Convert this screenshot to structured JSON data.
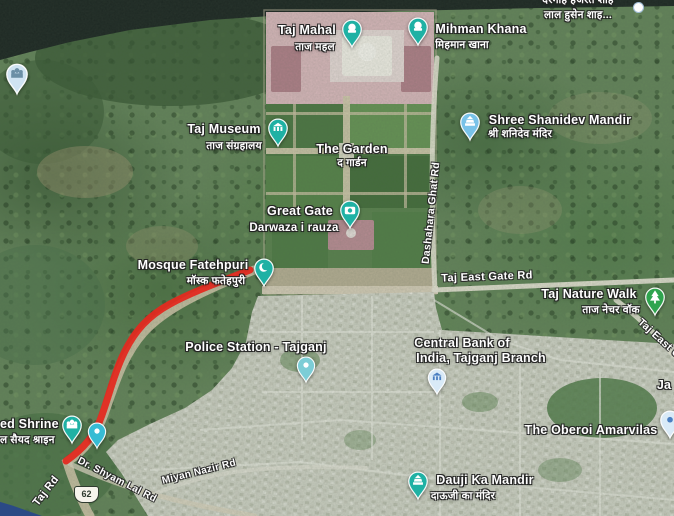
{
  "map": {
    "view_type": "satellite",
    "route": {
      "color": "#e2291f",
      "width": 7,
      "path": "M 250 270 C 222 281 192 292 170 304 C 148 316 135 331 125 351 C 115 371 110 392 102 415 C 95 436 83 449 66 461"
    },
    "shield": {
      "number": "62"
    },
    "markers": [
      {
        "id": "taj-mahal",
        "pin": {
          "x": 352,
          "y": 49,
          "w": 22,
          "h": 30,
          "color": "#1fb1a4",
          "icon": "monument",
          "icon_color": "#ffffff"
        },
        "labels": [
          {
            "text": "Taj Mahal",
            "x": 307,
            "y": 30,
            "size": 12.5
          },
          {
            "text": "ताज महल",
            "x": 315,
            "y": 47,
            "size": 10.5,
            "kind": "hindi"
          }
        ]
      },
      {
        "id": "mihman-khana",
        "pin": {
          "x": 418,
          "y": 47,
          "w": 22,
          "h": 30,
          "color": "#1fb1a4",
          "icon": "monument",
          "icon_color": "#ffffff"
        },
        "labels": [
          {
            "text": "Mihman Khana",
            "x": 481,
            "y": 29,
            "size": 12.5
          },
          {
            "text": "मिहमान खाना",
            "x": 462,
            "y": 45,
            "size": 10.5,
            "kind": "hindi"
          }
        ]
      },
      {
        "id": "taj-museum",
        "pin": {
          "x": 278,
          "y": 148,
          "w": 22,
          "h": 30,
          "color": "#1fb1a4",
          "icon": "museum",
          "icon_color": "#ffffff"
        },
        "labels": [
          {
            "text": "Taj Museum",
            "x": 224,
            "y": 129,
            "size": 12.5
          },
          {
            "text": "ताज संग्रहालय",
            "x": 234,
            "y": 146,
            "size": 10.5,
            "kind": "hindi"
          }
        ]
      },
      {
        "id": "the-garden",
        "labels": [
          {
            "text": "The Garden",
            "x": 352,
            "y": 149,
            "size": 12.5
          },
          {
            "text": "द गार्डन",
            "x": 352,
            "y": 163,
            "size": 10.5,
            "kind": "hindi"
          }
        ]
      },
      {
        "id": "great-gate",
        "pin": {
          "x": 350,
          "y": 230,
          "w": 22,
          "h": 30,
          "color": "#1fb1a4",
          "icon": "camera",
          "icon_color": "#ffffff"
        },
        "labels": [
          {
            "text": "Great Gate",
            "x": 300,
            "y": 211,
            "size": 12.5
          },
          {
            "text": "Darwaza i rauza",
            "x": 294,
            "y": 228,
            "size": 11.5
          }
        ]
      },
      {
        "id": "mosque-fatehpuri",
        "pin": {
          "x": 264,
          "y": 288,
          "w": 22,
          "h": 30,
          "color": "#1fb1a4",
          "icon": "mosque",
          "icon_color": "#ffffff"
        },
        "labels": [
          {
            "text": "Mosque Fatehpuri",
            "x": 193,
            "y": 265,
            "size": 12.5
          },
          {
            "text": "मॉस्क फतेहपुरी",
            "x": 216,
            "y": 281,
            "size": 10.5,
            "kind": "hindi"
          }
        ]
      },
      {
        "id": "shree-shanidev-mandir",
        "pin": {
          "x": 470,
          "y": 142,
          "w": 22,
          "h": 30,
          "color": "#79c2e8",
          "icon": "temple",
          "icon_color": "#ffffff"
        },
        "labels": [
          {
            "text": "Shree Shanidev Mandir",
            "x": 560,
            "y": 120,
            "size": 12.5
          },
          {
            "text": "श्री शनिदेव मंदिर",
            "x": 520,
            "y": 134,
            "size": 10.5,
            "kind": "hindi"
          }
        ]
      },
      {
        "id": "taj-nature-walk",
        "pin": {
          "x": 655,
          "y": 317,
          "w": 22,
          "h": 30,
          "color": "#2fa44e",
          "icon": "tree",
          "icon_color": "#ffffff"
        },
        "labels": [
          {
            "text": "Taj Nature Walk",
            "x": 589,
            "y": 294,
            "size": 12.5
          },
          {
            "text": "ताज नेचर वॉक",
            "x": 611,
            "y": 310,
            "size": 10.5,
            "kind": "hindi"
          }
        ]
      },
      {
        "id": "police-station-tajganj",
        "pin": {
          "x": 306,
          "y": 384,
          "w": 20,
          "h": 28,
          "color": "#7ccdd6",
          "icon": "dot",
          "icon_color": "#ffffff"
        },
        "labels": [
          {
            "text": "Police Station - Tajganj",
            "x": 256,
            "y": 347,
            "size": 12.5
          }
        ]
      },
      {
        "id": "central-bank-tajganj",
        "pin": {
          "x": 437,
          "y": 396,
          "w": 20,
          "h": 28,
          "color": "#d9eaf7",
          "icon": "bank",
          "icon_color": "#4a7fc1"
        },
        "labels": [
          {
            "text": "Central Bank of",
            "x": 462,
            "y": 343,
            "size": 12.5
          },
          {
            "text": "India, Tajganj Branch",
            "x": 481,
            "y": 358,
            "size": 12.5
          }
        ]
      },
      {
        "id": "oberoi-amarvilas",
        "pin": {
          "x": 670,
          "y": 440,
          "w": 22,
          "h": 30,
          "color": "#d9eaf7",
          "icon": "dot",
          "icon_color": "#4a7fc1"
        },
        "labels": [
          {
            "text": "The Oberoi Amarvilas",
            "x": 591,
            "y": 430,
            "size": 12.5
          }
        ]
      },
      {
        "id": "dauji-ka-mandir",
        "pin": {
          "x": 418,
          "y": 501,
          "w": 22,
          "h": 30,
          "color": "#1fb1a4",
          "icon": "temple",
          "icon_color": "#ffffff"
        },
        "labels": [
          {
            "text": "Dauji Ka Mandir",
            "x": 485,
            "y": 480,
            "size": 12.5
          },
          {
            "text": "दाऊजी का मंदिर",
            "x": 463,
            "y": 496,
            "size": 10.5,
            "kind": "hindi"
          }
        ]
      },
      {
        "id": "syed-shrine",
        "pin": {
          "x": 72,
          "y": 445,
          "w": 22,
          "h": 30,
          "color": "#1fb1a4",
          "icon": "shrine",
          "icon_color": "#ffffff"
        },
        "labels": [
          {
            "text": "ed Shrine",
            "x": 0,
            "y": 424,
            "size": 12.5,
            "anchor": "left"
          },
          {
            "text": "ल सैयद श्राइन",
            "x": 0,
            "y": 440,
            "size": 10.5,
            "kind": "hindi",
            "anchor": "left"
          }
        ]
      },
      {
        "id": "shrine-neighbor",
        "pin": {
          "x": 97,
          "y": 450,
          "w": 20,
          "h": 28,
          "color": "#37bcd4",
          "icon": "dot",
          "icon_color": "#ffffff"
        },
        "labels": []
      },
      {
        "id": "riverside-poi",
        "pin": {
          "x": 17,
          "y": 96,
          "w": 24,
          "h": 33,
          "color": "#cfe3f2",
          "icon": "shrine",
          "icon_color": "#6b8fa6"
        },
        "labels": []
      },
      {
        "id": "dargah-label",
        "labels": [
          {
            "text": "दरगाह हजरत शाह",
            "x": 578,
            "y": 0,
            "size": 10.5,
            "kind": "hindi"
          },
          {
            "text": "लाल हुसेन शाह...",
            "x": 578,
            "y": 15,
            "size": 10.5,
            "kind": "hindi"
          }
        ]
      },
      {
        "id": "ja-partial",
        "labels": [
          {
            "text": "Ja",
            "x": 664,
            "y": 385,
            "size": 12.5
          }
        ]
      }
    ],
    "road_labels": [
      {
        "id": "dashahara-ghat-rd",
        "text": "Dashahara Ghat Rd",
        "x": 431,
        "y": 213,
        "rotate": -84,
        "size": 10.5
      },
      {
        "id": "taj-east-gate-rd",
        "text": "Taj East Gate Rd",
        "x": 487,
        "y": 277,
        "rotate": -2,
        "size": 11
      },
      {
        "id": "taj-east-gate-rd-clipped",
        "text": "Taj East Gate Rd",
        "x": 672,
        "y": 350,
        "rotate": 42,
        "size": 10.5
      },
      {
        "id": "taj-rd",
        "text": "Taj Rd",
        "x": 46,
        "y": 491,
        "rotate": -52,
        "size": 11
      },
      {
        "id": "dr-shyam-lal-rd",
        "text": "Dr. Shyam Lal Rd",
        "x": 117,
        "y": 480,
        "rotate": 27,
        "size": 10
      },
      {
        "id": "miyan-nazir-rd",
        "text": "Miyan Nazir Rd",
        "x": 199,
        "y": 472,
        "rotate": -14,
        "size": 10
      }
    ]
  }
}
